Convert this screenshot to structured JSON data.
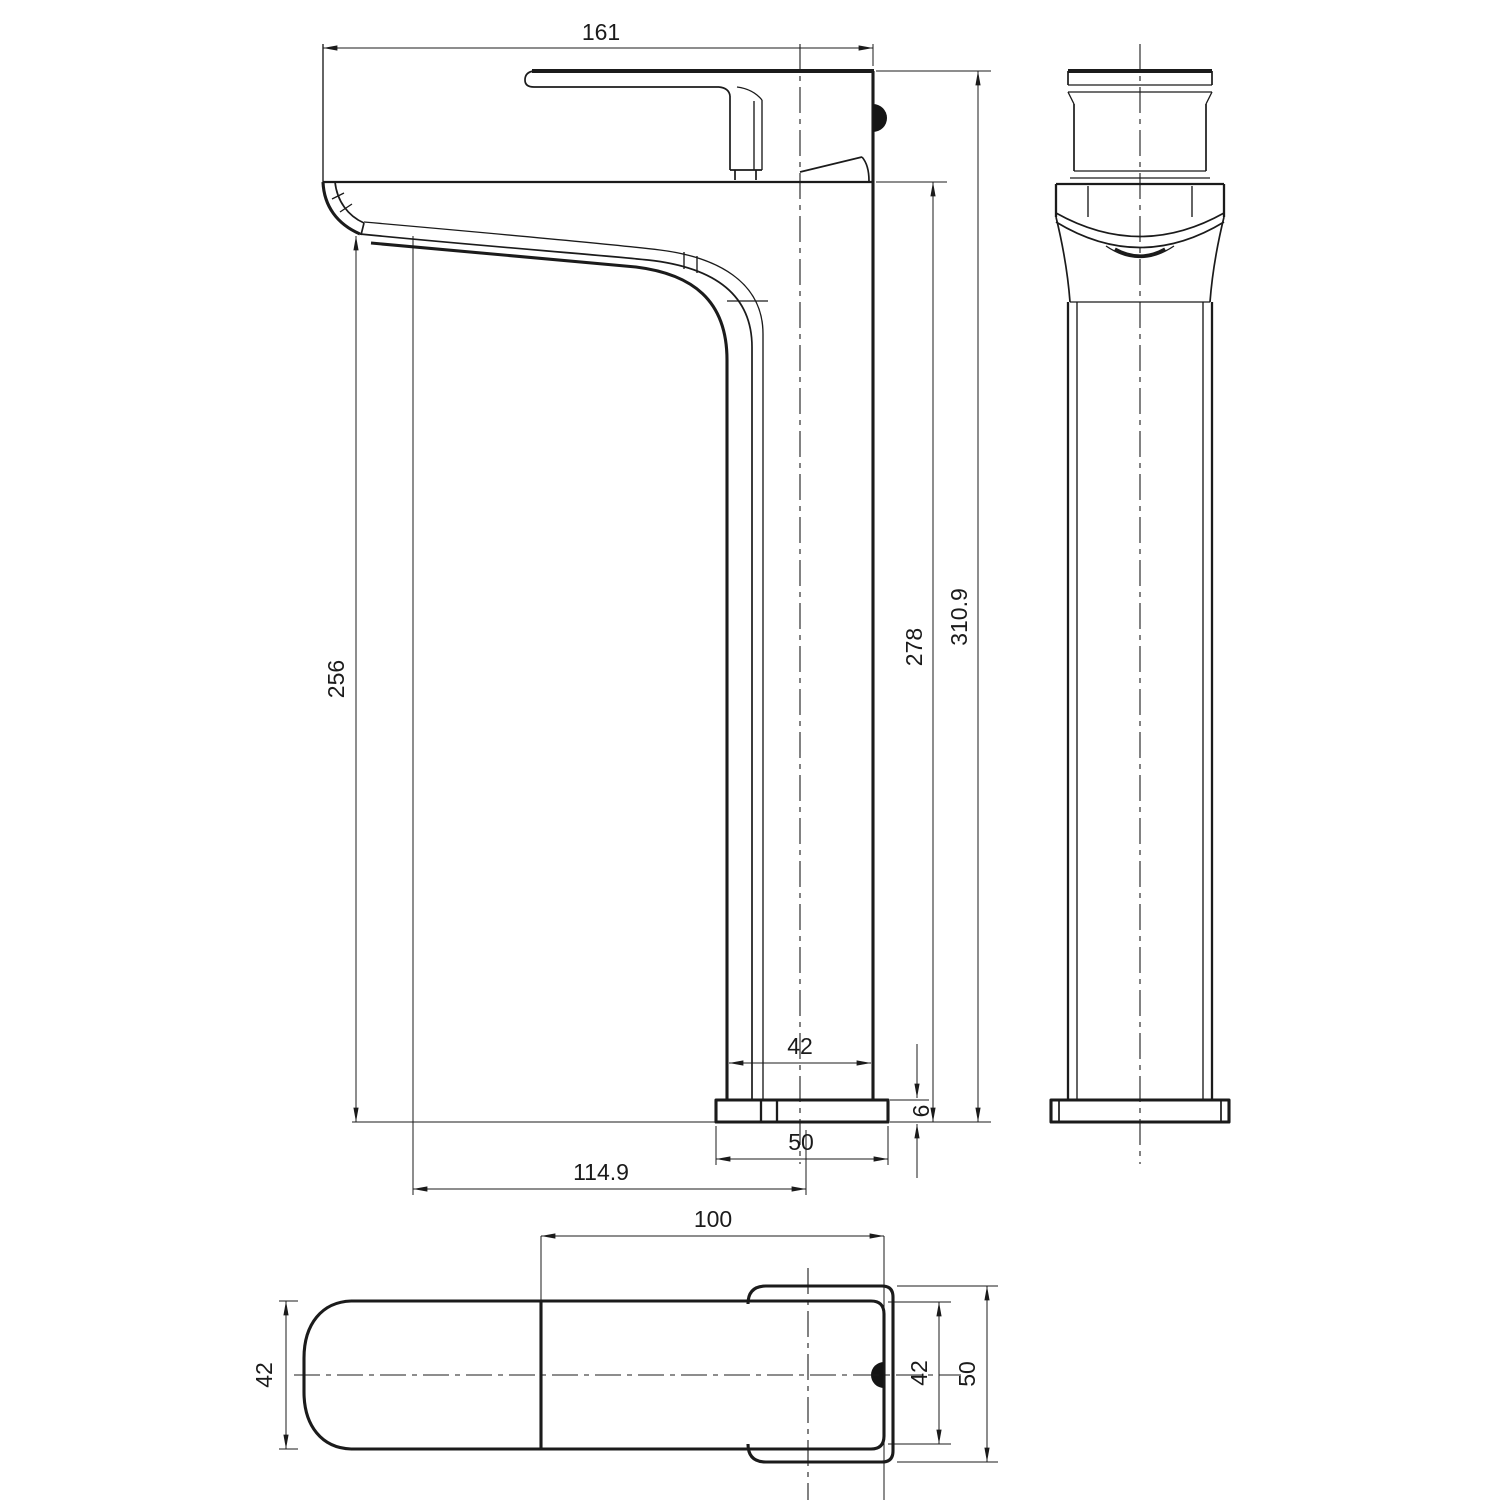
{
  "drawing": {
    "kind": "orthographic technical drawing",
    "subject": "tall single-lever basin mixer tap",
    "units": "mm",
    "ink_color": "#1b1b1b",
    "paper_color": "#ffffff",
    "views": [
      "side",
      "front",
      "top"
    ]
  },
  "dimensions": {
    "side": {
      "overall_length": "161",
      "height_to_spout_tip": "256",
      "height_to_spout_top": "278",
      "overall_height": "310.9",
      "column_width": "42",
      "base_plate_thickness": "6",
      "base_plate_width": "50",
      "spout_reach": "114.9"
    },
    "top": {
      "handle_length": "100",
      "handle_width_left": "42",
      "handle_width_right": "42",
      "base_plate_depth": "50"
    }
  }
}
